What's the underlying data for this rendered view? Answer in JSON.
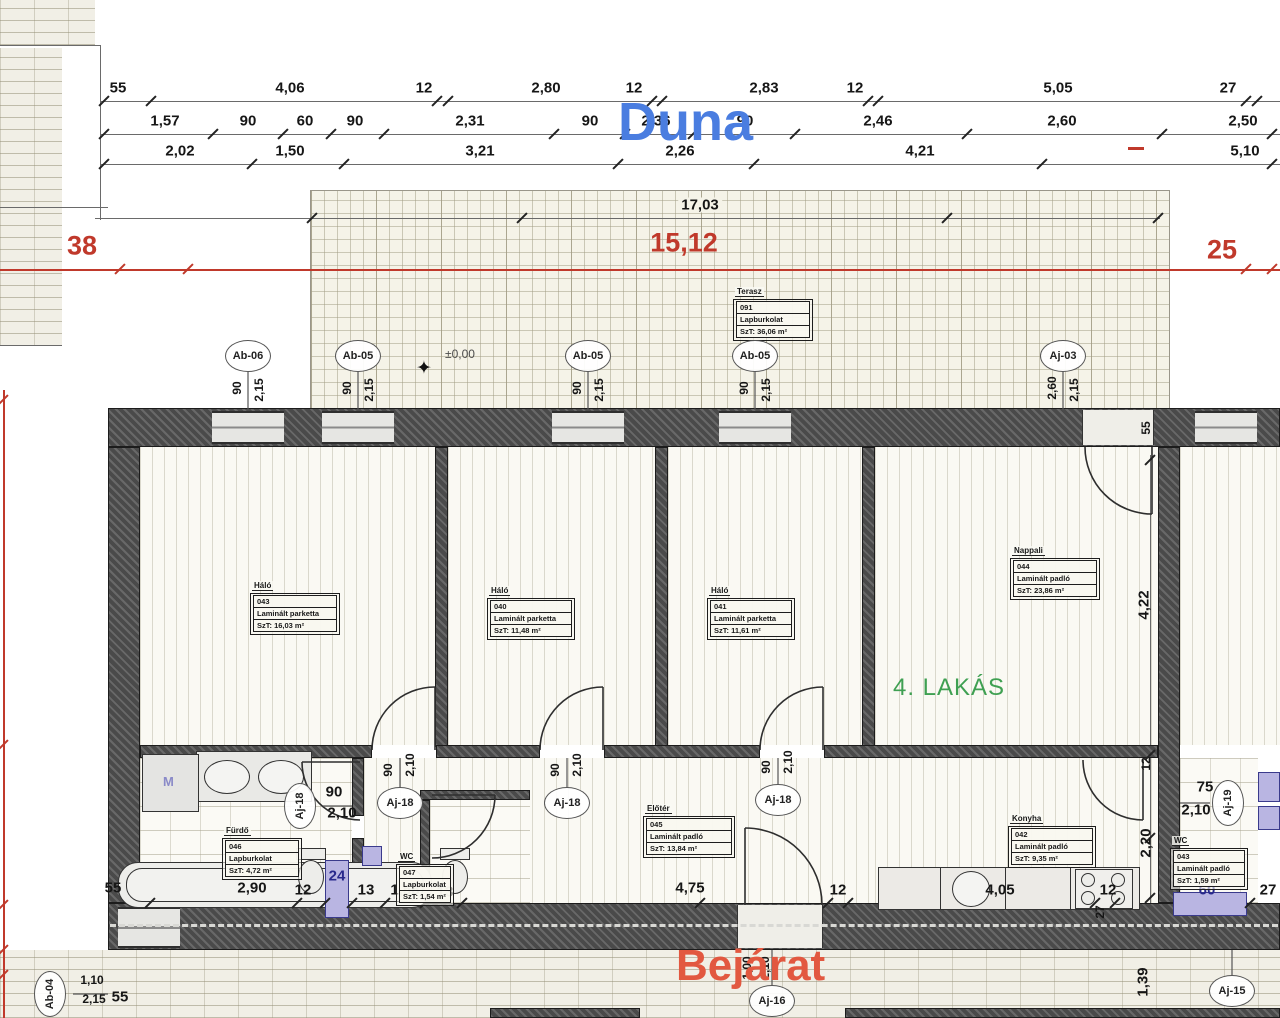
{
  "labels": {
    "duna": "Duna",
    "bejarat": "Bejárat",
    "apartment": "4. LAKÁS",
    "level": "±0,00",
    "washing_machine": "M"
  },
  "colors": {
    "duna_blue": "#4a7de0",
    "bejarat_red": "#e25840",
    "apartment_green": "#3fa052",
    "dimension_red": "#c0392b",
    "fixture_purple": "#b9b5e2",
    "navy": "#28288c"
  },
  "dim_texts": [
    {
      "t": "55",
      "x": 118,
      "y": 88
    },
    {
      "t": "4,06",
      "x": 290,
      "y": 88
    },
    {
      "t": "12",
      "x": 424,
      "y": 88
    },
    {
      "t": "2,80",
      "x": 546,
      "y": 88
    },
    {
      "t": "12",
      "x": 634,
      "y": 88
    },
    {
      "t": "2,83",
      "x": 764,
      "y": 88
    },
    {
      "t": "12",
      "x": 855,
      "y": 88
    },
    {
      "t": "5,05",
      "x": 1058,
      "y": 88
    },
    {
      "t": "27",
      "x": 1228,
      "y": 88
    },
    {
      "t": "1,57",
      "x": 165,
      "y": 121
    },
    {
      "t": "90",
      "x": 248,
      "y": 121
    },
    {
      "t": "60",
      "x": 305,
      "y": 121
    },
    {
      "t": "90",
      "x": 355,
      "y": 121
    },
    {
      "t": "2,31",
      "x": 470,
      "y": 121
    },
    {
      "t": "90",
      "x": 590,
      "y": 121
    },
    {
      "t": "2,36",
      "x": 656,
      "y": 121
    },
    {
      "t": "90",
      "x": 745,
      "y": 121
    },
    {
      "t": "2,46",
      "x": 878,
      "y": 121
    },
    {
      "t": "2,60",
      "x": 1062,
      "y": 121
    },
    {
      "t": "2,50",
      "x": 1243,
      "y": 121
    },
    {
      "t": "2,02",
      "x": 180,
      "y": 151
    },
    {
      "t": "1,50",
      "x": 290,
      "y": 151
    },
    {
      "t": "3,21",
      "x": 480,
      "y": 151
    },
    {
      "t": "2,26",
      "x": 680,
      "y": 151
    },
    {
      "t": "4,21",
      "x": 920,
      "y": 151
    },
    {
      "t": "5,10",
      "x": 1245,
      "y": 151
    },
    {
      "t": "17,03",
      "x": 700,
      "y": 205,
      "cls": "bg"
    },
    {
      "t": "38",
      "x": 82,
      "y": 246,
      "cls": "red"
    },
    {
      "t": "15,12",
      "x": 684,
      "y": 243,
      "cls": "red"
    },
    {
      "t": "25",
      "x": 1222,
      "y": 250,
      "cls": "red"
    },
    {
      "t": "90",
      "x": 237,
      "y": 388,
      "cls": "sm rot"
    },
    {
      "t": "2,15",
      "x": 259,
      "y": 390,
      "cls": "sm rot"
    },
    {
      "t": "90",
      "x": 347,
      "y": 388,
      "cls": "sm rot"
    },
    {
      "t": "2,15",
      "x": 369,
      "y": 390,
      "cls": "sm rot"
    },
    {
      "t": "90",
      "x": 577,
      "y": 388,
      "cls": "sm rot"
    },
    {
      "t": "2,15",
      "x": 599,
      "y": 390,
      "cls": "sm rot"
    },
    {
      "t": "90",
      "x": 744,
      "y": 388,
      "cls": "sm rot"
    },
    {
      "t": "2,15",
      "x": 766,
      "y": 390,
      "cls": "sm rot"
    },
    {
      "t": "2,60",
      "x": 1052,
      "y": 388,
      "cls": "sm rot"
    },
    {
      "t": "2,15",
      "x": 1074,
      "y": 390,
      "cls": "sm rot"
    },
    {
      "t": "55",
      "x": 1146,
      "y": 428,
      "cls": "sm rot"
    },
    {
      "t": "4,22",
      "x": 1144,
      "y": 605,
      "cls": "rot"
    },
    {
      "t": "12",
      "x": 1146,
      "y": 764,
      "cls": "sm rot"
    },
    {
      "t": "2,20",
      "x": 1146,
      "y": 843,
      "cls": "rot"
    },
    {
      "t": "1,39",
      "x": 1143,
      "y": 982,
      "cls": "rot"
    },
    {
      "t": "90",
      "x": 334,
      "y": 792
    },
    {
      "t": "2,10",
      "x": 342,
      "y": 813
    },
    {
      "t": "90",
      "x": 388,
      "y": 770,
      "cls": "sm rot"
    },
    {
      "t": "2,10",
      "x": 410,
      "y": 765,
      "cls": "sm rot"
    },
    {
      "t": "90",
      "x": 555,
      "y": 770,
      "cls": "sm rot"
    },
    {
      "t": "2,10",
      "x": 577,
      "y": 765,
      "cls": "sm rot"
    },
    {
      "t": "90",
      "x": 766,
      "y": 767,
      "cls": "sm rot"
    },
    {
      "t": "2,10",
      "x": 788,
      "y": 762,
      "cls": "sm rot"
    },
    {
      "t": "75",
      "x": 1205,
      "y": 787
    },
    {
      "t": "2,10",
      "x": 1196,
      "y": 810
    },
    {
      "t": "1,00",
      "x": 747,
      "y": 968,
      "cls": "sm rot"
    },
    {
      "t": "2,10",
      "x": 765,
      "y": 968,
      "cls": "sm rot"
    },
    {
      "t": "1,10",
      "x": 92,
      "y": 980,
      "cls": "sm"
    },
    {
      "t": "2,15",
      "x": 94,
      "y": 999,
      "cls": "sm"
    },
    {
      "t": "55",
      "x": 120,
      "y": 997
    },
    {
      "t": "55",
      "x": 113,
      "y": 888
    },
    {
      "t": "2,90",
      "x": 252,
      "y": 888
    },
    {
      "t": "12",
      "x": 303,
      "y": 890
    },
    {
      "t": "24",
      "x": 337,
      "y": 876,
      "cls": "navy"
    },
    {
      "t": "13",
      "x": 366,
      "y": 890
    },
    {
      "t": "1,58",
      "x": 405,
      "y": 890
    },
    {
      "t": "13",
      "x": 445,
      "y": 892
    },
    {
      "t": "4,75",
      "x": 690,
      "y": 888
    },
    {
      "t": "12",
      "x": 838,
      "y": 890
    },
    {
      "t": "4,05",
      "x": 1000,
      "y": 890
    },
    {
      "t": "12",
      "x": 1108,
      "y": 890
    },
    {
      "t": "27",
      "x": 1100,
      "y": 912,
      "cls": "sm rot"
    },
    {
      "t": "60",
      "x": 1207,
      "y": 890,
      "cls": "navy"
    },
    {
      "t": "27",
      "x": 1268,
      "y": 890
    }
  ],
  "marker_circles": [
    {
      "t": "Ab-06",
      "x": 248,
      "y": 356
    },
    {
      "t": "Ab-05",
      "x": 358,
      "y": 356
    },
    {
      "t": "Ab-05",
      "x": 588,
      "y": 356
    },
    {
      "t": "Ab-05",
      "x": 755,
      "y": 356
    },
    {
      "t": "Aj-03",
      "x": 1063,
      "y": 356
    },
    {
      "t": "Aj-18",
      "x": 300,
      "y": 806,
      "rot": 1
    },
    {
      "t": "Aj-18",
      "x": 400,
      "y": 803
    },
    {
      "t": "Aj-18",
      "x": 567,
      "y": 803
    },
    {
      "t": "Aj-18",
      "x": 778,
      "y": 800
    },
    {
      "t": "Aj-19",
      "x": 1228,
      "y": 803,
      "rot": 1
    },
    {
      "t": "Aj-16",
      "x": 772,
      "y": 1001
    },
    {
      "t": "Aj-15",
      "x": 1232,
      "y": 991
    },
    {
      "t": "Ab-04",
      "x": 50,
      "y": 994,
      "rot": 1
    }
  ],
  "room_boxes": [
    {
      "title": "Terasz",
      "rows": [
        "091",
        "Lapburkolat",
        "SzT: 36,06 m²"
      ],
      "x": 733,
      "y": 281,
      "w": 80
    },
    {
      "title": "Háló",
      "rows": [
        "043",
        "Laminált parketta",
        "SzT: 16,03 m²"
      ],
      "x": 250,
      "y": 575,
      "w": 90
    },
    {
      "title": "Háló",
      "rows": [
        "040",
        "Laminált parketta",
        "SzT: 11,48 m²"
      ],
      "x": 487,
      "y": 580,
      "w": 88
    },
    {
      "title": "Háló",
      "rows": [
        "041",
        "Laminált parketta",
        "SzT: 11,61 m²"
      ],
      "x": 707,
      "y": 580,
      "w": 88
    },
    {
      "title": "Nappali",
      "rows": [
        "044",
        "Laminált padló",
        "SzT: 23,86 m²"
      ],
      "x": 1010,
      "y": 540,
      "w": 90
    },
    {
      "title": "Előtér",
      "rows": [
        "045",
        "Laminált padló",
        "SzT: 13,84 m²"
      ],
      "x": 643,
      "y": 798,
      "w": 92
    },
    {
      "title": "Konyha",
      "rows": [
        "042",
        "Laminált padló",
        "SzT: 9,35 m²"
      ],
      "x": 1008,
      "y": 808,
      "w": 88
    },
    {
      "title": "Fürdő",
      "rows": [
        "046",
        "Lapburkolat",
        "SzT: 4,72 m²"
      ],
      "x": 222,
      "y": 820,
      "w": 80
    },
    {
      "title": "WC",
      "rows": [
        "047",
        "Lapburkolat",
        "SzT: 1,54 m²"
      ],
      "x": 396,
      "y": 846,
      "w": 58
    },
    {
      "title": "WC",
      "rows": [
        "043",
        "Laminált padló",
        "SzT: 1,59 m²"
      ],
      "x": 1170,
      "y": 830,
      "w": 78
    }
  ]
}
